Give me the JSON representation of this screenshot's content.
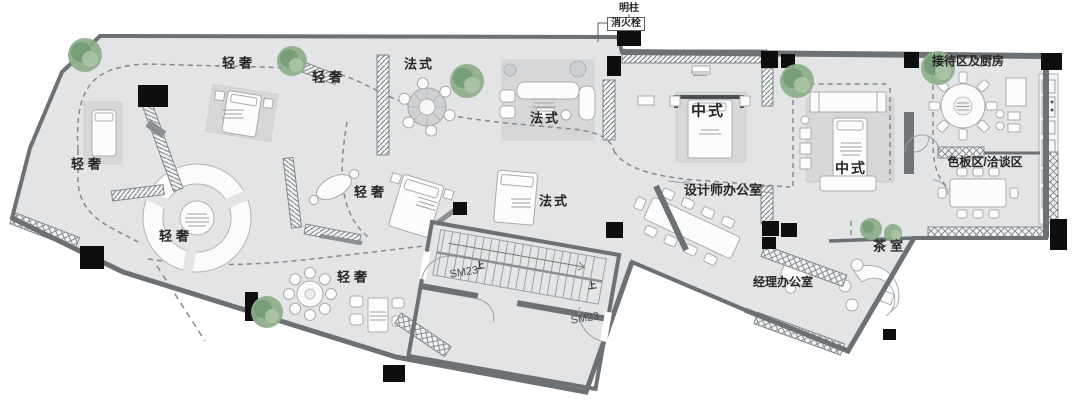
{
  "colors": {
    "background": "#ffffff",
    "floor": "#e3e4e6",
    "rug": "#d5d7d9",
    "wall": "#6c7175",
    "wall_dark": "#585d61",
    "column": "#0e0e0e",
    "furniture_fill": "#fcfcfc",
    "furniture_stroke": "#a8acaf",
    "tree": "#8fae8d",
    "tree_dark": "#6f9a72",
    "dash": "#85898c",
    "text": "#262626"
  },
  "labels": [
    {
      "id": "note-pillar",
      "text": "明柱",
      "x": 629,
      "y": 9,
      "size": 10
    },
    {
      "id": "note-fire-hydrant",
      "text": "消火栓",
      "x": 626,
      "y": 24,
      "size": 10,
      "boxed": true
    },
    {
      "id": "zone-light-luxury-1",
      "text": "轻奢",
      "x": 239,
      "y": 63,
      "size": 13,
      "ls": 4
    },
    {
      "id": "zone-light-luxury-2",
      "text": "轻奢",
      "x": 329,
      "y": 77,
      "size": 13,
      "ls": 4
    },
    {
      "id": "zone-light-luxury-3",
      "text": "轻奢",
      "x": 88,
      "y": 164,
      "size": 13,
      "ls": 4
    },
    {
      "id": "zone-light-luxury-4",
      "text": "轻奢",
      "x": 371,
      "y": 192,
      "size": 13,
      "ls": 4
    },
    {
      "id": "zone-light-luxury-5",
      "text": "轻奢",
      "x": 176,
      "y": 236,
      "size": 13,
      "ls": 4
    },
    {
      "id": "zone-light-luxury-6",
      "text": "轻奢",
      "x": 354,
      "y": 277,
      "size": 13,
      "ls": 4
    },
    {
      "id": "zone-french-1",
      "text": "法式",
      "x": 419,
      "y": 64,
      "size": 13,
      "ls": 2
    },
    {
      "id": "zone-french-2",
      "text": "法式",
      "x": 545,
      "y": 118,
      "size": 13,
      "ls": 2
    },
    {
      "id": "zone-french-3",
      "text": "法式",
      "x": 554,
      "y": 201,
      "size": 13,
      "ls": 2
    },
    {
      "id": "zone-chinese-1",
      "text": "中式",
      "x": 708,
      "y": 111,
      "size": 15,
      "ls": 2,
      "weight": 700
    },
    {
      "id": "zone-chinese-2",
      "text": "中式",
      "x": 851,
      "y": 168,
      "size": 14,
      "ls": 2
    },
    {
      "id": "room-designer-office",
      "text": "设计师办公室",
      "x": 723,
      "y": 190,
      "size": 13
    },
    {
      "id": "room-manager-office",
      "text": "经理办公室",
      "x": 783,
      "y": 282,
      "size": 12
    },
    {
      "id": "room-tea",
      "text": "茶室",
      "x": 890,
      "y": 246,
      "size": 13,
      "ls": 4
    },
    {
      "id": "room-reception-kitchen",
      "text": "接待区及厨房",
      "x": 968,
      "y": 61,
      "size": 12
    },
    {
      "id": "room-material-talk",
      "text": "色板区/洽谈区",
      "x": 985,
      "y": 162,
      "size": 12
    },
    {
      "id": "door-sm23-1",
      "text": "SM23",
      "x": 464,
      "y": 273,
      "size": 11,
      "rotate": -9,
      "color": "#4a4f53",
      "weight": 500
    },
    {
      "id": "door-sm23-2",
      "text": "SM23",
      "x": 585,
      "y": 319,
      "size": 11,
      "rotate": -9,
      "color": "#4a4f53",
      "weight": 500
    },
    {
      "id": "stair-up-1",
      "text": "上",
      "x": 480,
      "y": 266,
      "size": 9,
      "rotate": -9
    },
    {
      "id": "stair-up-2",
      "text": "上",
      "x": 592,
      "y": 286,
      "size": 9,
      "rotate": -9
    }
  ]
}
